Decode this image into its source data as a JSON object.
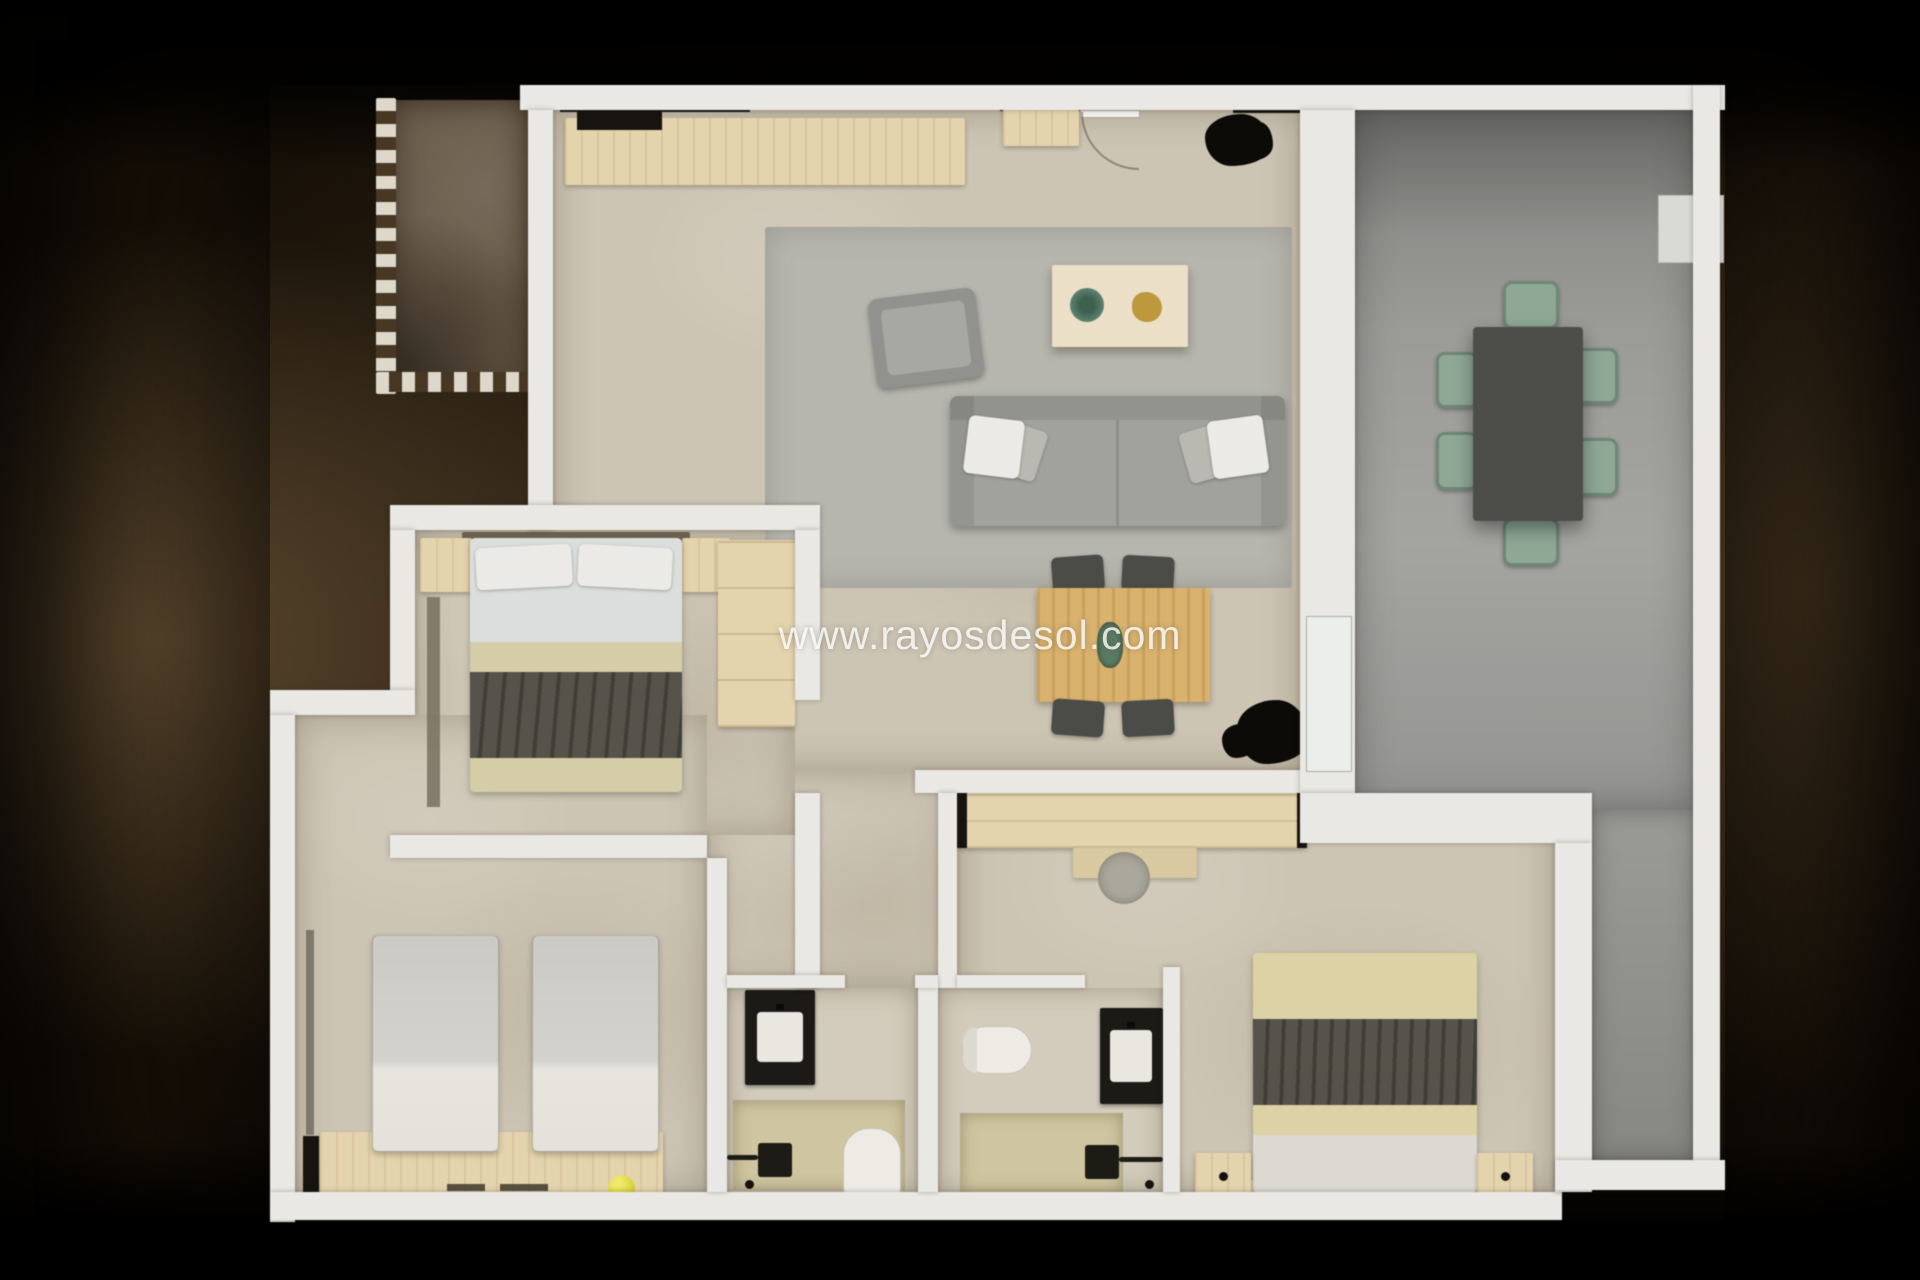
{
  "watermark": "www.rayosdesol.com",
  "palette": {
    "wall": "#e9e8e4",
    "floor": "#cdc5b4",
    "bath": "#d3ccbc",
    "balcony": "#6b5d4b",
    "rug": "#b6b6ae",
    "wood": "#e4d4ae",
    "wood2": "#d9b26e",
    "sofa": "#a2a29d",
    "blanket": "#56544a",
    "green": "#8fa896",
    "tabledark": "#4d4d4a",
    "yellow": "#d9d43b",
    "plant": "#0c0b08"
  },
  "floor_plan": {
    "type": "apartment-3d-top-view",
    "rooms": [
      {
        "name": "balcony-top-left",
        "features": [
          "brown-tile-floor",
          "dashed-railing"
        ]
      },
      {
        "name": "kitchen-living-dining",
        "features": [
          "kitchen-counter",
          "entrance-door",
          "armchair",
          "coffee-table",
          "sofa",
          "rug",
          "dining-table",
          "four-chairs",
          "two-plants",
          "terrace-glass-door"
        ]
      },
      {
        "name": "terrace-right",
        "features": [
          "outdoor-dining-table",
          "six-green-chairs",
          "ac-unit"
        ]
      },
      {
        "name": "bedroom-1-top-left",
        "features": [
          "double-bed",
          "two-nightstands",
          "wardrobe",
          "runner-rug"
        ]
      },
      {
        "name": "bedroom-2-bottom-left",
        "features": [
          "two-single-beds",
          "wood-bench-headboard",
          "yellow-ball"
        ]
      },
      {
        "name": "bedroom-3-bottom-right",
        "features": [
          "double-bed",
          "two-nightstands",
          "wardrobe",
          "dresser",
          "round-stool"
        ]
      },
      {
        "name": "bathroom-1",
        "features": [
          "black-vanity",
          "shower",
          "toilet"
        ]
      },
      {
        "name": "bathroom-2",
        "features": [
          "black-vanity",
          "shower",
          "toilet"
        ]
      }
    ]
  }
}
